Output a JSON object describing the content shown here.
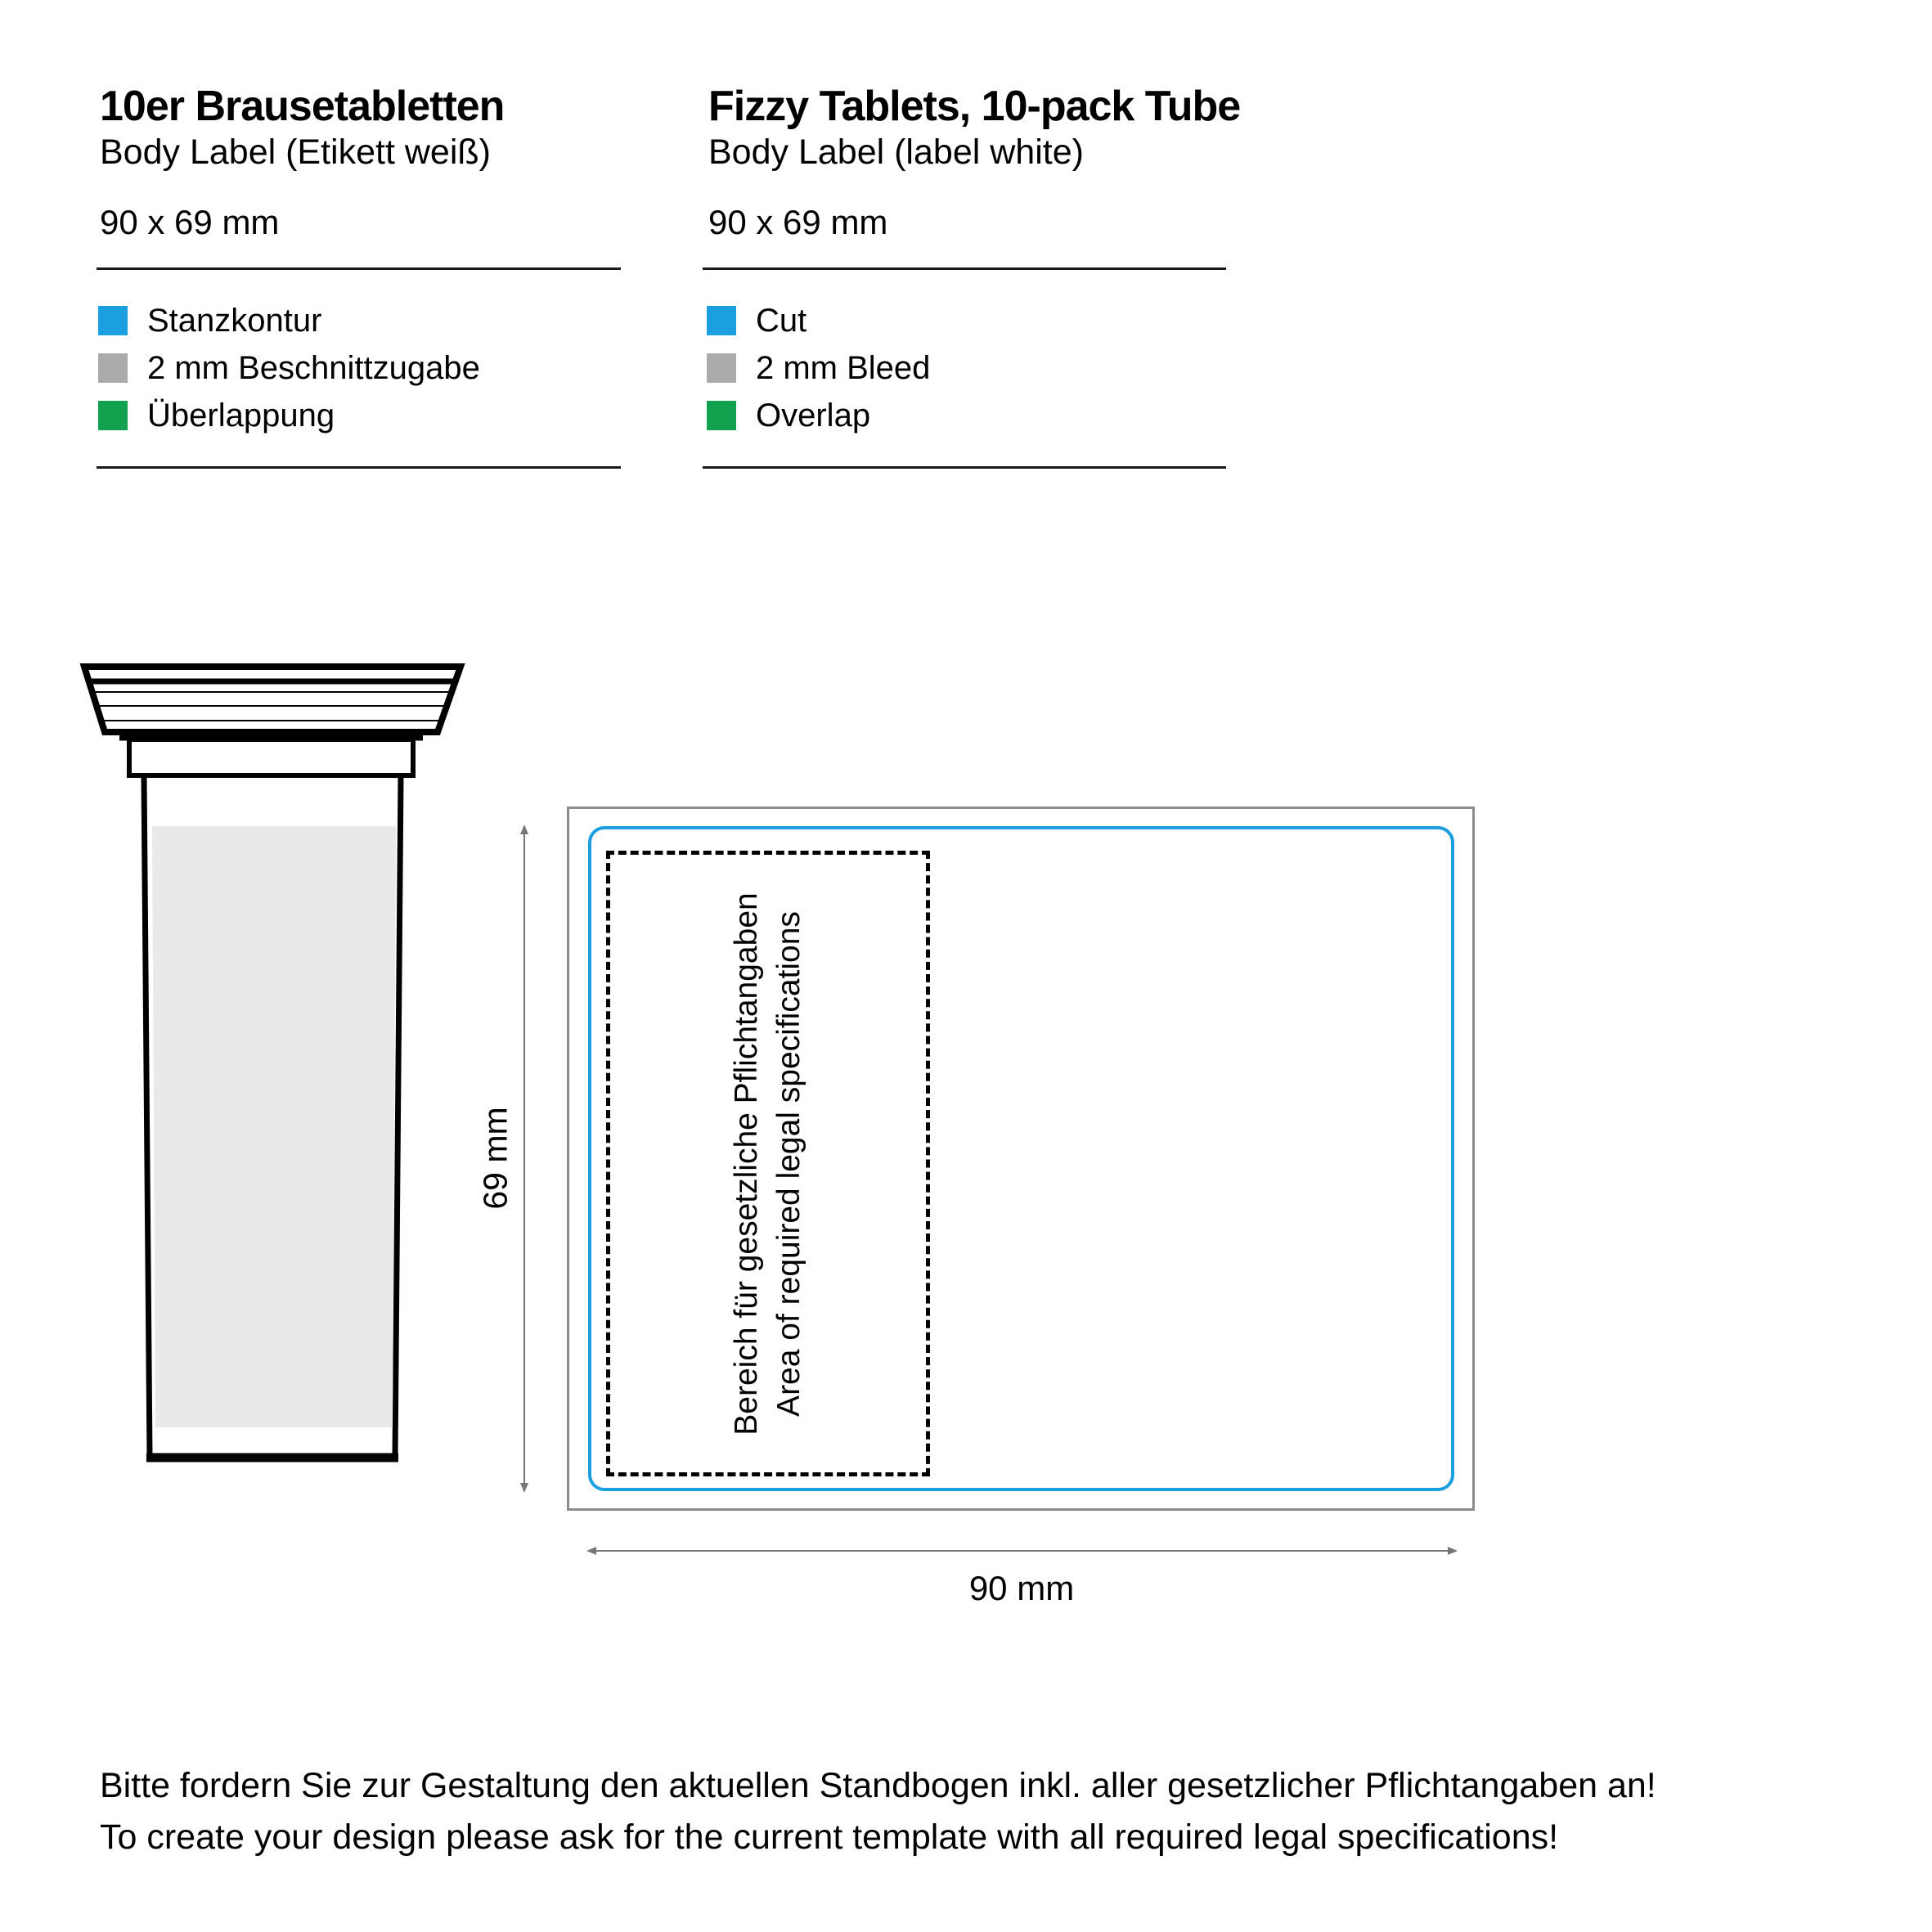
{
  "header_left": {
    "title": "10er Brausetabletten",
    "subtitle": "Body Label (Etikett weiß)",
    "size": "90 x 69 mm"
  },
  "header_right": {
    "title": "Fizzy Tablets, 10-pack Tube",
    "subtitle": "Body Label (label white)",
    "size": "90 x 69 mm"
  },
  "legend_left": {
    "items": [
      {
        "label": "Stanzkontur"
      },
      {
        "label": "2 mm Beschnittzugabe"
      },
      {
        "label": "Überlappung"
      }
    ]
  },
  "legend_right": {
    "items": [
      {
        "label": "Cut"
      },
      {
        "label": "2 mm Bleed"
      },
      {
        "label": "Overlap"
      }
    ]
  },
  "colors": {
    "cut": "#1B9FE0",
    "bleed": "#ABABAB",
    "overlap": "#12A24F"
  },
  "dieline": {
    "legal_area_line1": "Bereich für gesetzliche Pflichtangaben",
    "legal_area_line2": "Area of required legal specifications",
    "height_label": "69 mm",
    "width_label": "90 mm"
  },
  "footer": {
    "line1": "Bitte fordern Sie zur Gestaltung den aktuellen Standbogen inkl. aller gesetzlicher Pflichtangaben an!",
    "line2": "To create your design please ask for the current template with all required legal specifications!"
  }
}
